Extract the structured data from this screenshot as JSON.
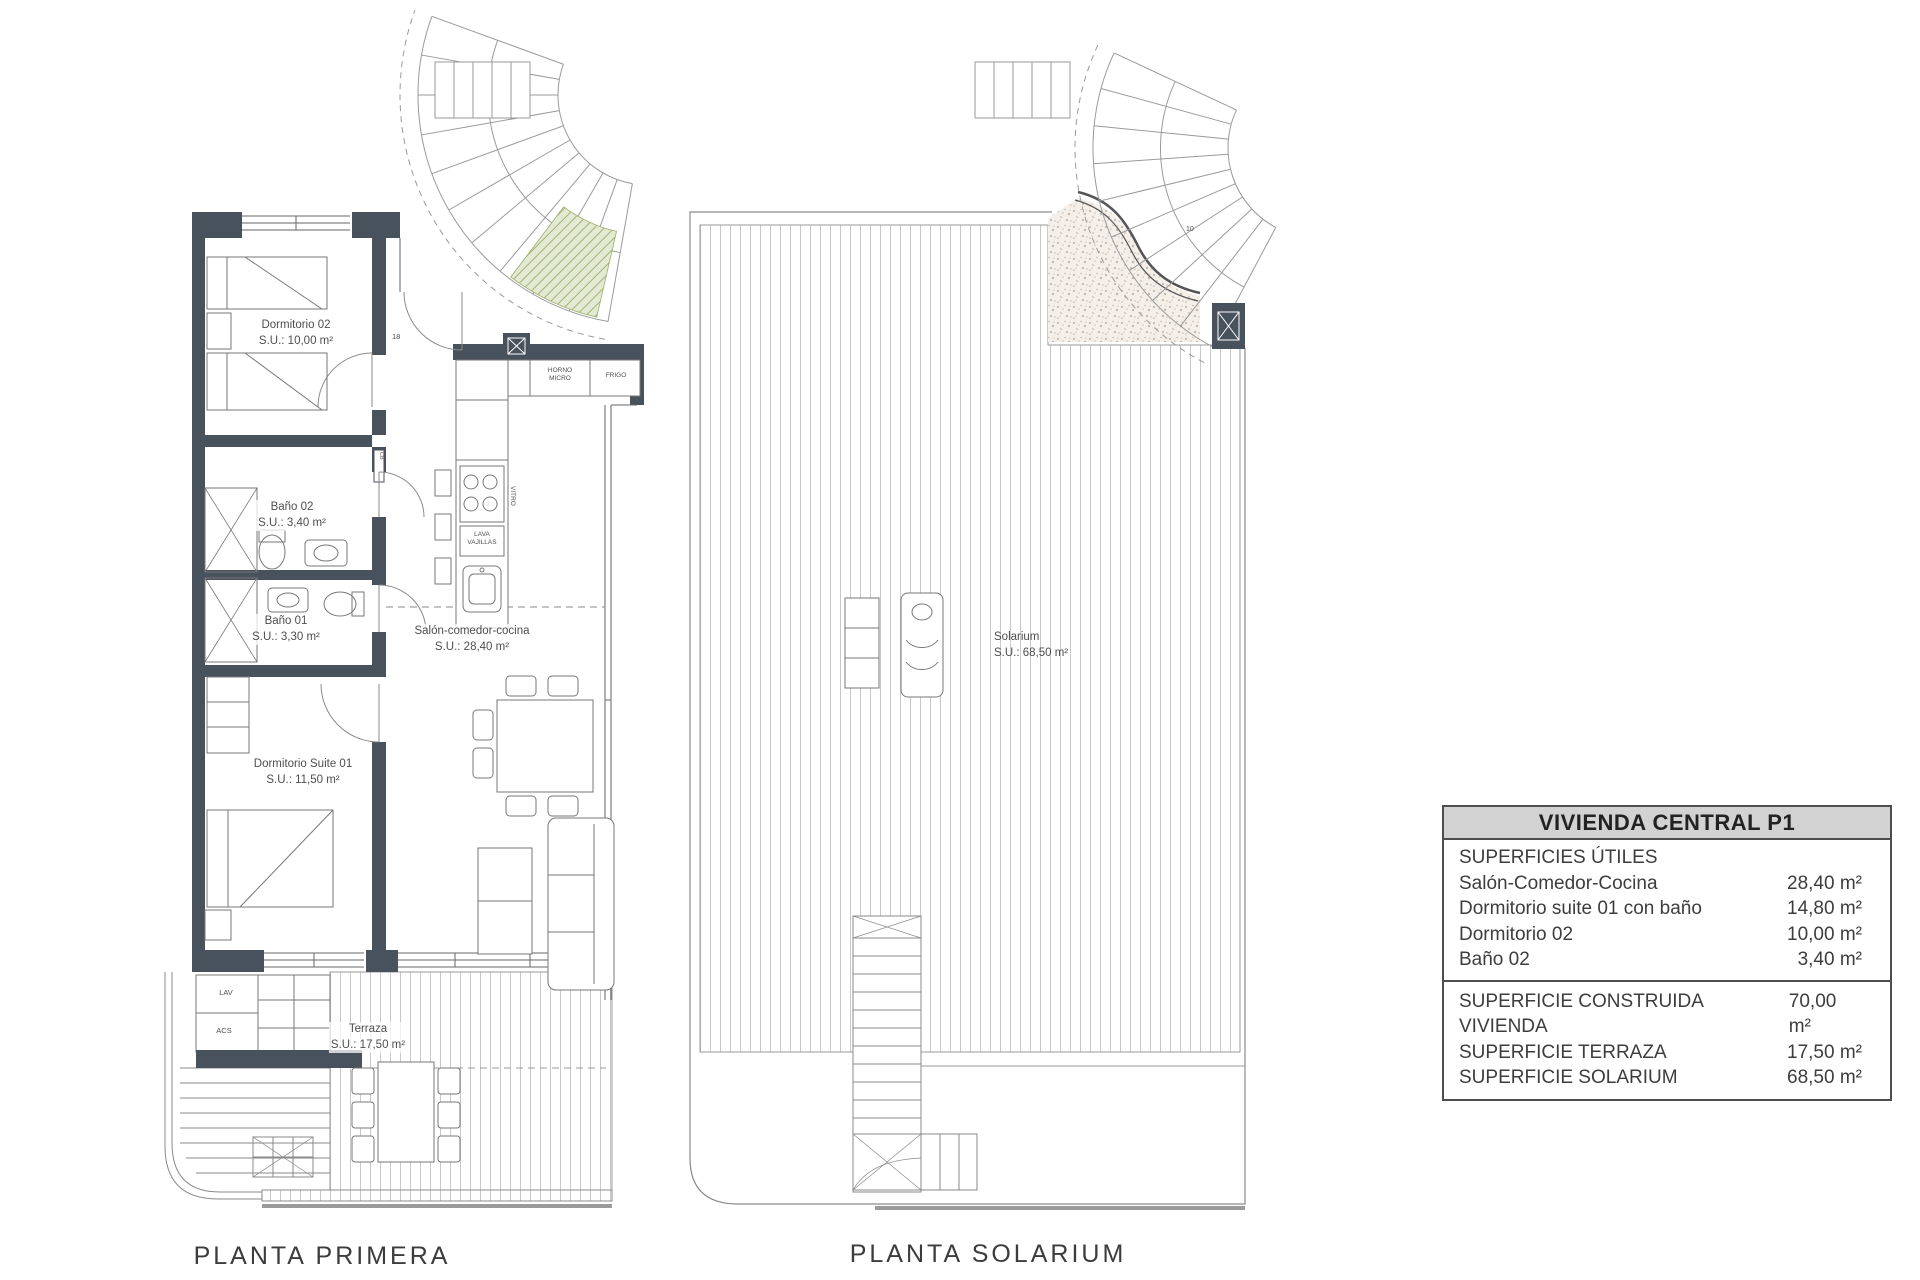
{
  "colors": {
    "wall": "#48525d",
    "line": "#7a7a7a",
    "deck_line": "#c8c8c8",
    "green_hatch": "#a3b377",
    "gravel_dot": "#c3b8a8",
    "table_header_bg": "#d2d2d2"
  },
  "plans": {
    "primera": {
      "title": "PLANTA PRIMERA",
      "rooms": {
        "dormitorio02": {
          "name": "Dormitorio 02",
          "area": "S.U.: 10,00 m²"
        },
        "bano02": {
          "name": "Baño 02",
          "area": "S.U.: 3,40 m²"
        },
        "bano01": {
          "name": "Baño 01",
          "area": "S.U.: 3,30 m²"
        },
        "suite01": {
          "name": "Dormitorio Suite 01",
          "area": "S.U.: 11,50 m²"
        },
        "salon": {
          "name": "Salón-comedor-cocina",
          "area": "S.U.: 28,40 m²"
        },
        "terraza": {
          "name": "Terraza",
          "area": "S.U.: 17,50 m²"
        }
      },
      "fixtures": {
        "horno_line1": "HORNO",
        "horno_line2": "MICRO",
        "frigo": "FRIGO",
        "lava_line1": "LAVA",
        "lava_line2": "VAJILLAS",
        "vitro": "VITRO",
        "lav": "LAV",
        "acs": "ACS",
        "cb": "CB",
        "step_count": "18"
      }
    },
    "solarium": {
      "title": "PLANTA SOLARIUM",
      "rooms": {
        "solarium": {
          "name": "Solarium",
          "area": "S.U.: 68,50 m²"
        }
      },
      "fixtures": {
        "step_count": "10"
      }
    }
  },
  "summary_table": {
    "title": "VIVIENDA CENTRAL P1",
    "useful_header": "SUPERFICIES ÚTILES",
    "useful_rows": [
      {
        "label": "Salón-Comedor-Cocina",
        "value": "28,40 m²"
      },
      {
        "label": "Dormitorio suite 01 con baño",
        "value": "14,80 m²"
      },
      {
        "label": "Dormitorio 02",
        "value": "10,00 m²"
      },
      {
        "label": "Baño 02",
        "value": "3,40 m²"
      }
    ],
    "total_rows": [
      {
        "label": "SUPERFICIE CONSTRUIDA VIVIENDA",
        "value": "70,00 m²"
      },
      {
        "label": "SUPERFICIE TERRAZA",
        "value": "17,50 m²"
      },
      {
        "label": "SUPERFICIE SOLARIUM",
        "value": "68,50 m²"
      }
    ]
  }
}
